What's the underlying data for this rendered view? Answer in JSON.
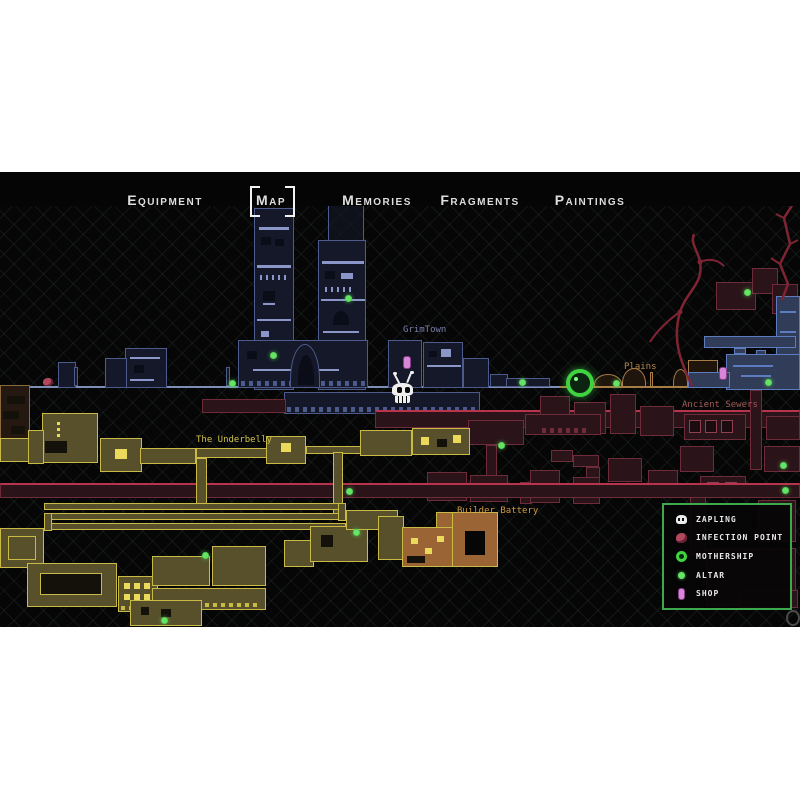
{
  "tabs": {
    "items": [
      {
        "label": "Equipment",
        "selected": false
      },
      {
        "label": "Map",
        "selected": true
      },
      {
        "label": "Memories",
        "selected": false
      },
      {
        "label": "Fragments",
        "selected": false
      },
      {
        "label": "Paintings",
        "selected": false
      }
    ]
  },
  "map": {
    "labels": {
      "grimtown": "GrimTown",
      "plains": "Plains",
      "ancient_sewers": "Ancient Sewers",
      "underbelly": "The Underbelly",
      "builder_battery": "Builder Battery"
    },
    "markers": {
      "altars": [
        {
          "x": 348,
          "y": 126
        },
        {
          "x": 273,
          "y": 183
        },
        {
          "x": 232,
          "y": 211
        },
        {
          "x": 522,
          "y": 210
        },
        {
          "x": 616,
          "y": 211
        },
        {
          "x": 768,
          "y": 210
        },
        {
          "x": 747,
          "y": 120
        },
        {
          "x": 783,
          "y": 293
        },
        {
          "x": 785,
          "y": 318
        },
        {
          "x": 501,
          "y": 273
        },
        {
          "x": 349,
          "y": 319
        },
        {
          "x": 205,
          "y": 383
        },
        {
          "x": 356,
          "y": 360
        },
        {
          "x": 164,
          "y": 448
        }
      ],
      "shops": [
        {
          "x": 406,
          "y": 189
        },
        {
          "x": 722,
          "y": 200
        }
      ],
      "infection_points": [
        {
          "x": 48,
          "y": 210
        }
      ],
      "mothership": {
        "x": 576,
        "y": 207
      },
      "player": {
        "x": 403,
        "y": 216,
        "name": "Zapling"
      }
    }
  },
  "legend": {
    "items": [
      {
        "icon": "zapling-icon",
        "label": "Zapling"
      },
      {
        "icon": "infection-point-icon",
        "label": "Infection Point"
      },
      {
        "icon": "mothership-icon",
        "label": "Mothership"
      },
      {
        "icon": "altar-icon",
        "label": "Altar"
      },
      {
        "icon": "shop-icon",
        "label": "Shop"
      }
    ]
  },
  "colors": {
    "legend_border": "#3da94c",
    "grimtown_outline": "#4d5a8c",
    "sewers_outline": "#6e2c3a",
    "sewers_highlight": "#b8344c",
    "underbelly_outline": "#c9ba45",
    "builder_fill": "#9a6434",
    "plains_outline": "#a87c45",
    "water_outline": "#5d7cc0",
    "altar_green": "#66e466",
    "mothership_green": "#3fd43f",
    "shop_pink": "#d986d9",
    "infection_red": "#b0495e"
  }
}
